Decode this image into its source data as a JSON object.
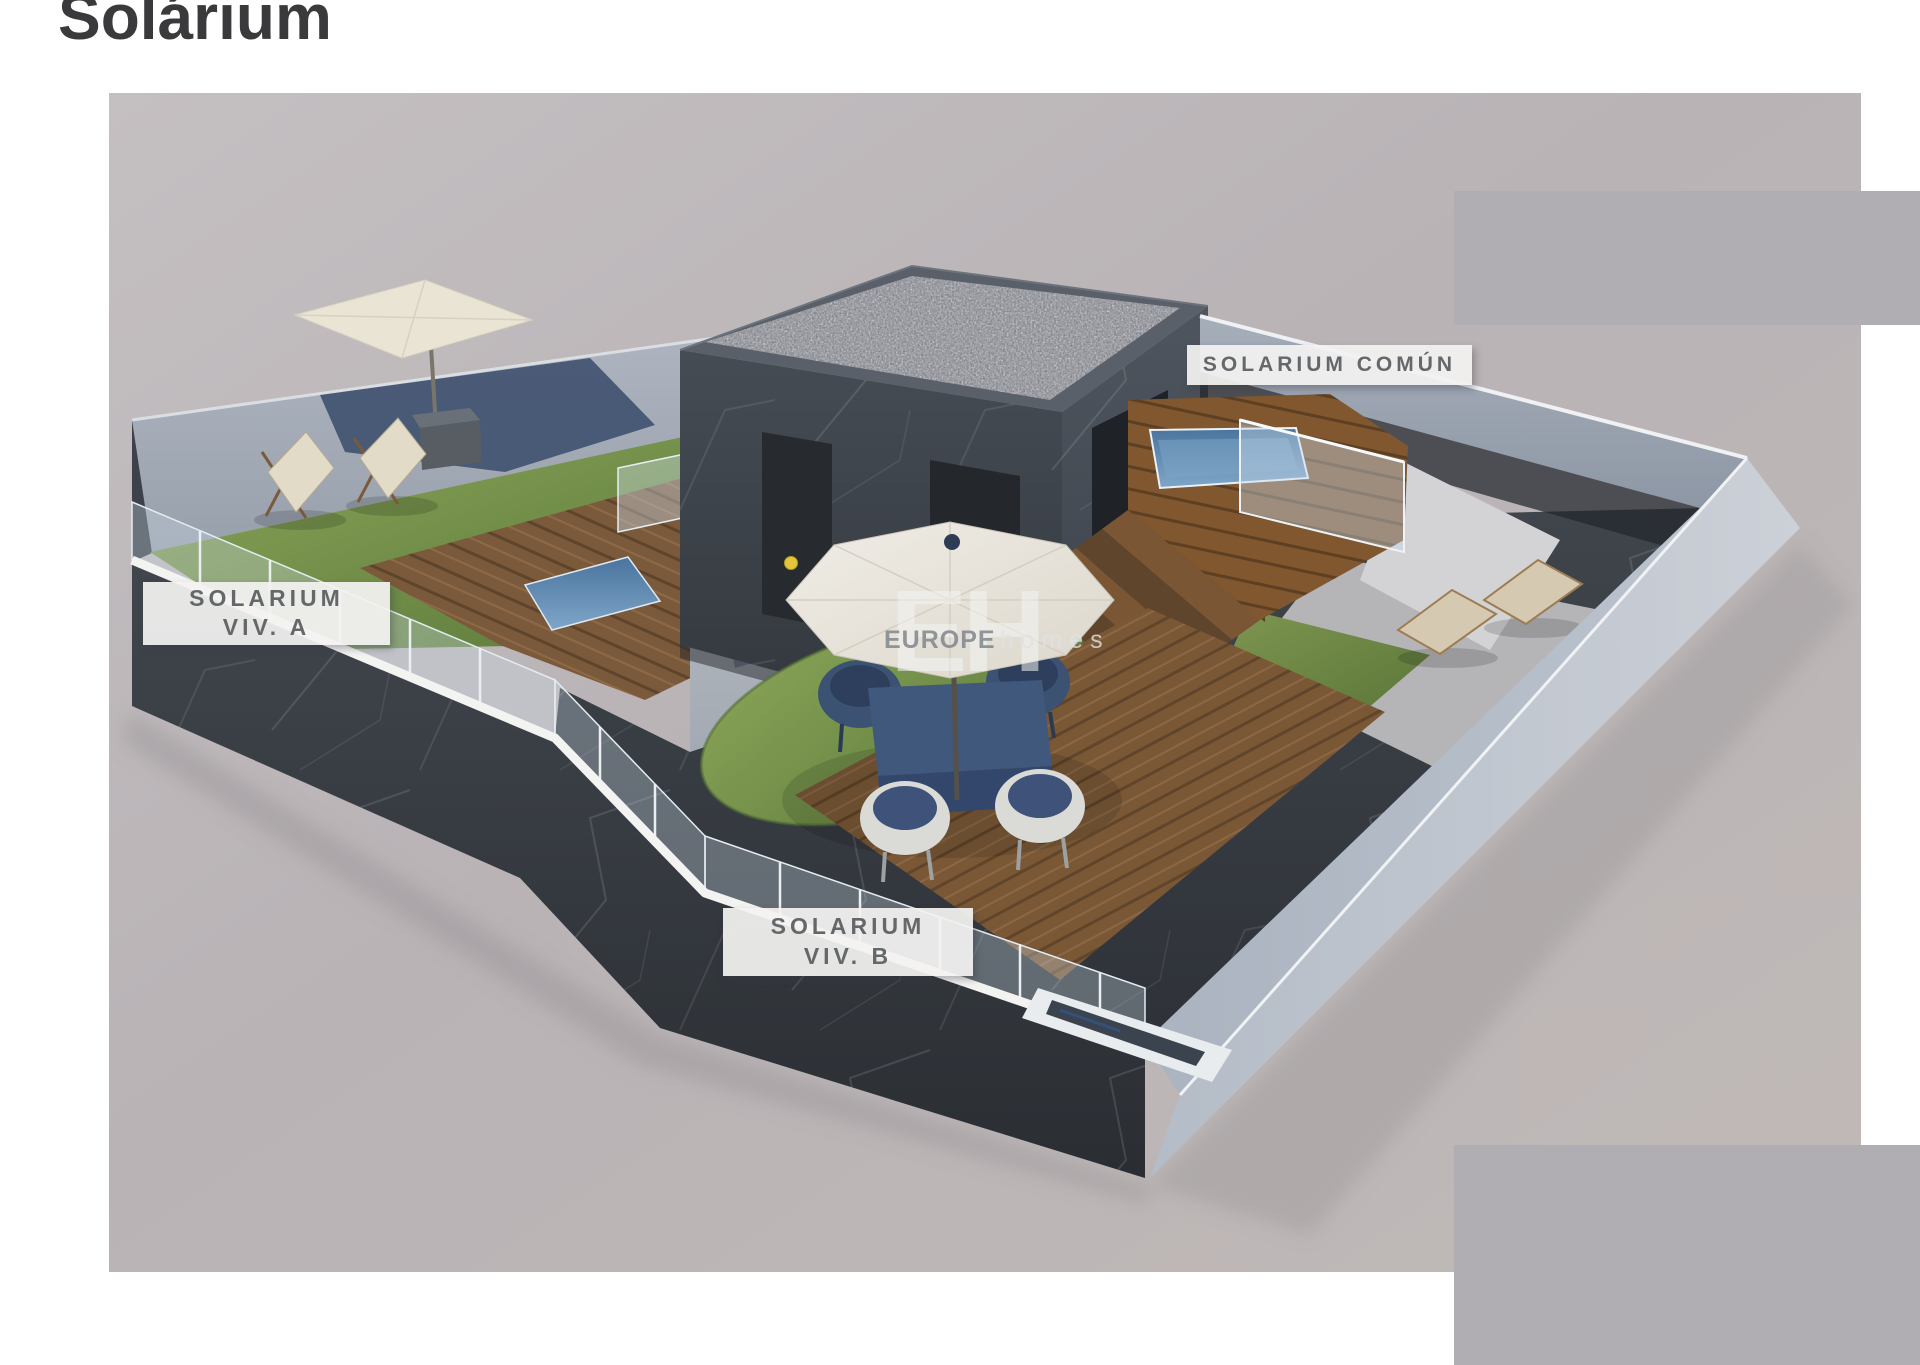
{
  "page": {
    "title": "Solárium"
  },
  "labels": {
    "viv_a": {
      "line1": "SOLARIUM",
      "line2": "VIV. A"
    },
    "viv_b": {
      "line1": "SOLARIUM",
      "line2": "VIV. B"
    },
    "comun": {
      "text": "SOLARIUM COMÚN"
    }
  },
  "watermark": {
    "initials": "EH",
    "brand_bold": "EUROPE",
    "brand_light": "homes"
  },
  "colors": {
    "page_background": "#ffffff",
    "render_background": "#b9b3b6",
    "censor_block": "#b1aeb3",
    "title_text": "#3a3a3c",
    "label_background": "#f3f2f1",
    "label_text": "#65686b",
    "dark_wall": "#3e434a",
    "light_wall": "#aab1bc",
    "wood_deck": "#7b5a3b",
    "grass": "#7d9a4b",
    "pool_water": "#5b84ad",
    "umbrella_canvas": "#eae4d6",
    "furniture_navy": "#3c5273",
    "roof_gravel": "#757888"
  }
}
